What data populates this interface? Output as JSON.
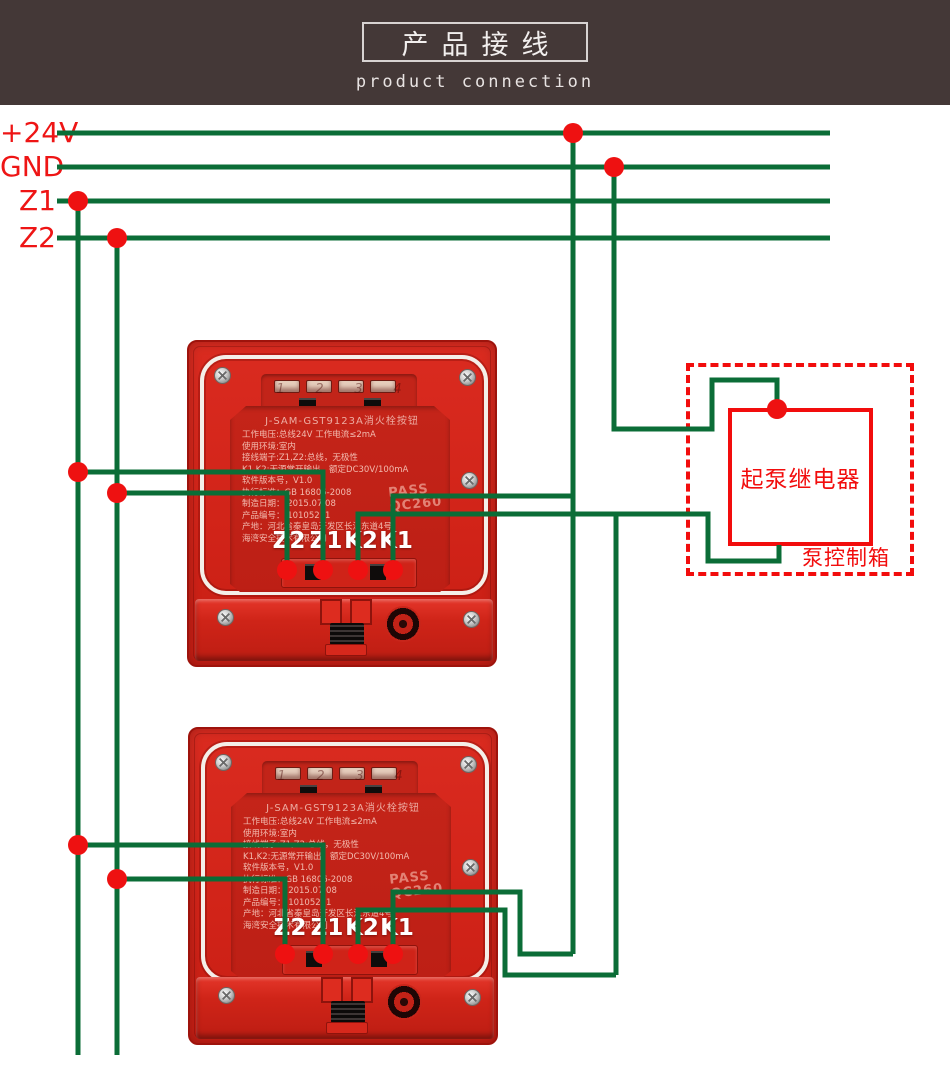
{
  "header": {
    "title": "产品接线",
    "subtitle": "product connection"
  },
  "bus": {
    "labels": [
      "+24V",
      "GND",
      "Z1",
      "Z2"
    ]
  },
  "device": {
    "model_title": "J-SAM-GST9123A消火栓按钮",
    "lines": [
      "工作电压:总线24V 工作电流≤2mA",
      "使用环境:室内",
      "接线端子:Z1,Z2:总线，无极性",
      "K1,K2:无源常开输出，额定DC30V/100mA",
      "软件版本号，V1.0",
      "执行标准：GB 16806-2008",
      "制造日期： 2015.07.08",
      "产品编号： 10105211",
      "产地：河北省秦皇岛开发区长江东道4号",
      "海湾安全技术有限公司"
    ],
    "pass_line1": "PASS",
    "pass_line2": "QC260",
    "slot_numbers": [
      "1",
      "2",
      "3",
      "4"
    ],
    "terminals": [
      "Z2",
      "Z1",
      "K2",
      "K1"
    ]
  },
  "relay": {
    "relay_label": "起泵继电器",
    "box_label": "泵控制箱"
  },
  "colors": {
    "wire_green": "#0b6d37",
    "signal_red": "#ee1515",
    "device_red": "#d12318",
    "header_brown": "#443837",
    "relay_red": "#f20d0d",
    "gasket_white": "#f4efe9"
  }
}
